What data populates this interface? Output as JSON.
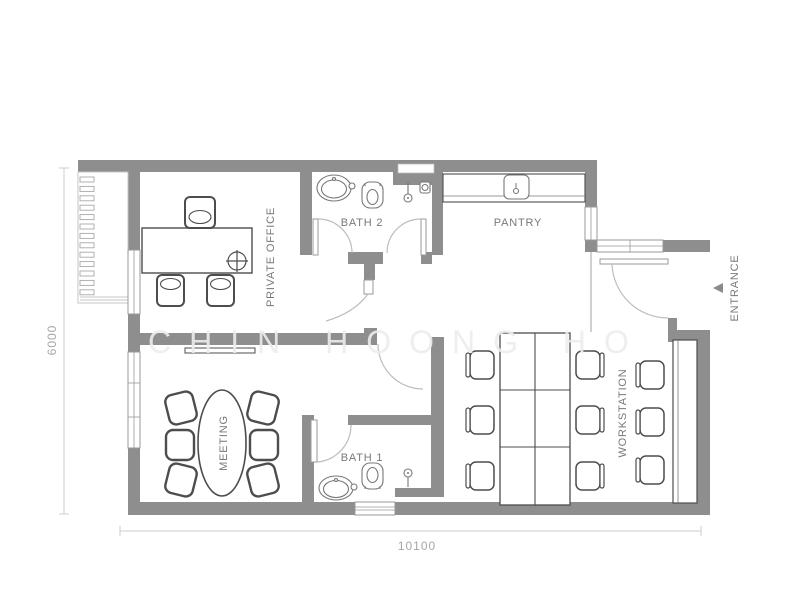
{
  "floor_plan": {
    "watermark": "CHIN HOONG HO",
    "rooms": {
      "private_office": "PRIVATE OFFICE",
      "bath_2": "BATH 2",
      "pantry": "PANTRY",
      "meeting": "MEETING",
      "bath_1": "BATH 1",
      "workstation": "WORKSTATION"
    },
    "entrance_label": "ENTRANCE",
    "dimensions": {
      "width": "10100",
      "height": "6000"
    },
    "colors": {
      "wall": "#8e8e8e",
      "furniture_line": "#4d4d4d",
      "fixture_line": "#777777",
      "label_text": "#787878",
      "dim_text": "#a6a6a6",
      "dim_line": "#cccccc",
      "door_arc": "#bdbdbd",
      "watermark": "#ededed"
    }
  }
}
